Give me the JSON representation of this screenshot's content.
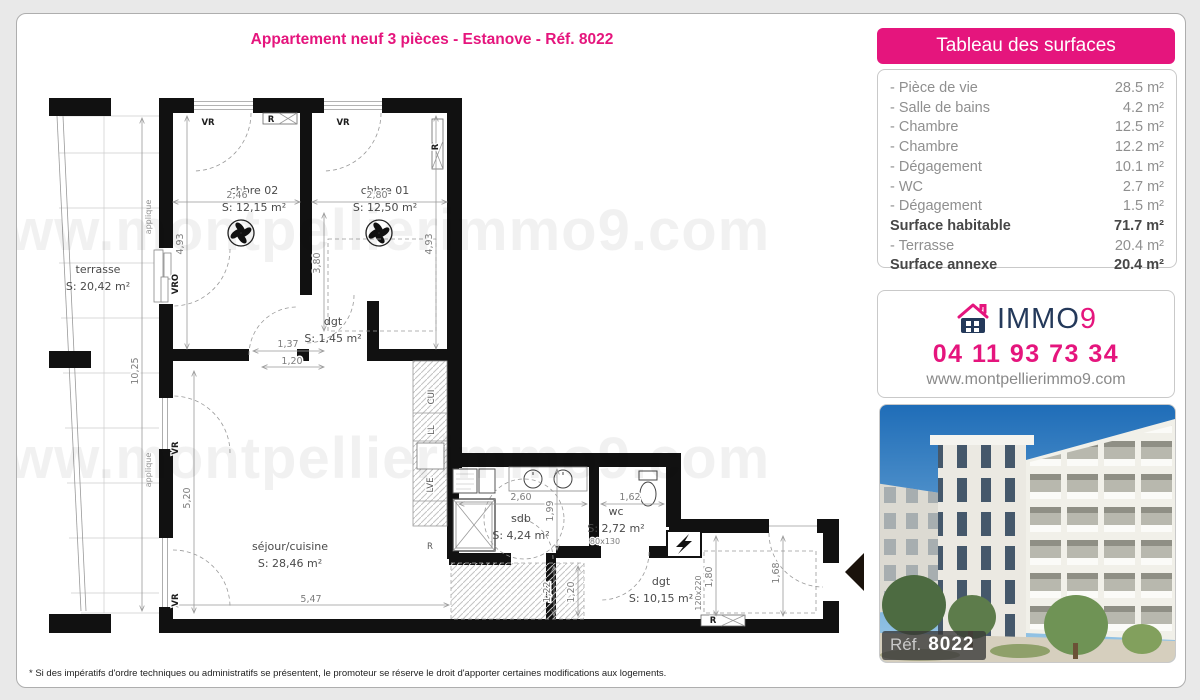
{
  "page": {
    "title": "Appartement neuf 3 pièces - Estanove - Réf. 8022",
    "watermark": "www.montpellierimmo9.com",
    "footnote": "* Si des impératifs d'ordre techniques ou administratifs se présentent, le promoteur se réserve le droit d'apporter certaines modifications aux logements."
  },
  "surfaces": {
    "header": "Tableau des surfaces",
    "rows": [
      {
        "label": "- Pièce de vie",
        "value": "28.5 m²",
        "bold": false
      },
      {
        "label": "- Salle de bains",
        "value": "4.2 m²",
        "bold": false
      },
      {
        "label": "- Chambre",
        "value": "12.5 m²",
        "bold": false
      },
      {
        "label": "- Chambre",
        "value": "12.2 m²",
        "bold": false
      },
      {
        "label": "- Dégagement",
        "value": "10.1 m²",
        "bold": false
      },
      {
        "label": "- WC",
        "value": "2.7 m²",
        "bold": false
      },
      {
        "label": "- Dégagement",
        "value": "1.5 m²",
        "bold": false
      },
      {
        "label": "Surface habitable",
        "value": "71.7 m²",
        "bold": true
      },
      {
        "label": "- Terrasse",
        "value": "20.4 m²",
        "bold": false
      },
      {
        "label": "Surface annexe",
        "value": "20.4 m²",
        "bold": true
      }
    ]
  },
  "agency": {
    "brand": "IMMO",
    "brand_accent": "9",
    "phone": "04 11 93 73 34",
    "website": "www.montpellierimmo9.com"
  },
  "photo": {
    "ref_label": "Réf.",
    "ref_number": "8022"
  },
  "colors": {
    "accent": "#e5157d",
    "navy": "#24395a"
  },
  "plan": {
    "rooms": [
      {
        "label": "terrasse",
        "area": "S: 20,42 m²",
        "x": 97,
        "y": 272
      },
      {
        "label": "chbre 02",
        "area": "S: 12,15 m²",
        "x": 253,
        "y": 193
      },
      {
        "label": "chbre 01",
        "area": "S: 12,50 m²",
        "x": 384,
        "y": 193
      },
      {
        "label": "dgt",
        "area": "S: 1,45 m²",
        "x": 332,
        "y": 324
      },
      {
        "label": "séjour/cuisine",
        "area": "S: 28,46 m²",
        "x": 289,
        "y": 549
      },
      {
        "label": "sdb",
        "area": "S: 4,24 m²",
        "x": 520,
        "y": 521
      },
      {
        "label": "wc",
        "area": "S: 2,72 m²",
        "x": 615,
        "y": 514
      },
      {
        "label": "dgt",
        "area": "S: 10,15 m²",
        "x": 660,
        "y": 584
      }
    ],
    "dimensions": [
      {
        "t": "2,46",
        "x": 236,
        "y": 197
      },
      {
        "t": "2,80",
        "x": 376,
        "y": 197
      },
      {
        "t": "1,37",
        "x": 287,
        "y": 346
      },
      {
        "t": "1,20",
        "x": 291,
        "y": 363
      },
      {
        "t": "5,47",
        "x": 310,
        "y": 601
      },
      {
        "t": "2,60",
        "x": 520,
        "y": 499
      },
      {
        "t": "1,62",
        "x": 629,
        "y": 499
      },
      {
        "t": "80x130",
        "x": 604,
        "y": 543,
        "cls": "dim-sm"
      },
      {
        "t": "4,93",
        "x": 182,
        "y": 243,
        "rot": -90
      },
      {
        "t": "3,80",
        "x": 319,
        "y": 262,
        "rot": -90
      },
      {
        "t": "4,93",
        "x": 431,
        "y": 243,
        "rot": -90
      },
      {
        "t": "10,25",
        "x": 137,
        "y": 370,
        "rot": -90
      },
      {
        "t": "5,20",
        "x": 189,
        "y": 497,
        "rot": -90
      },
      {
        "t": "1,99",
        "x": 552,
        "y": 510,
        "rot": -90
      },
      {
        "t": "1,22",
        "x": 549,
        "y": 591,
        "rot": -90
      },
      {
        "t": "1,20",
        "x": 573,
        "y": 591,
        "rot": -90
      },
      {
        "t": "1,80",
        "x": 711,
        "y": 576,
        "rot": -90
      },
      {
        "t": "1,68",
        "x": 778,
        "y": 572,
        "rot": -90
      },
      {
        "t": "120x220",
        "x": 700,
        "y": 592,
        "rot": -90,
        "cls": "dim-sm"
      }
    ],
    "annotations": [
      {
        "t": "VR",
        "x": 207,
        "y": 124
      },
      {
        "t": "VR",
        "x": 342,
        "y": 124
      },
      {
        "t": "R",
        "x": 270,
        "y": 121
      },
      {
        "t": "R",
        "x": 437,
        "y": 146,
        "rot": -90
      },
      {
        "t": "VRO",
        "x": 177,
        "y": 283,
        "rot": -90
      },
      {
        "t": "VR",
        "x": 177,
        "y": 447,
        "rot": -90
      },
      {
        "t": "VR",
        "x": 177,
        "y": 599,
        "rot": -90
      },
      {
        "t": "applique",
        "x": 150,
        "y": 216,
        "rot": -90,
        "cls": "annl"
      },
      {
        "t": "applique",
        "x": 150,
        "y": 469,
        "rot": -90,
        "cls": "annl"
      },
      {
        "t": "CUI",
        "x": 433,
        "y": 396,
        "rot": -90,
        "cls": "ann2"
      },
      {
        "t": "LL",
        "x": 433,
        "y": 429,
        "rot": -90,
        "cls": "ann2"
      },
      {
        "t": "LVE",
        "x": 432,
        "y": 484,
        "rot": -90,
        "cls": "ann2"
      },
      {
        "t": "R",
        "x": 429,
        "y": 548,
        "cls": "ann2"
      },
      {
        "t": "R",
        "x": 712,
        "y": 622
      }
    ]
  }
}
